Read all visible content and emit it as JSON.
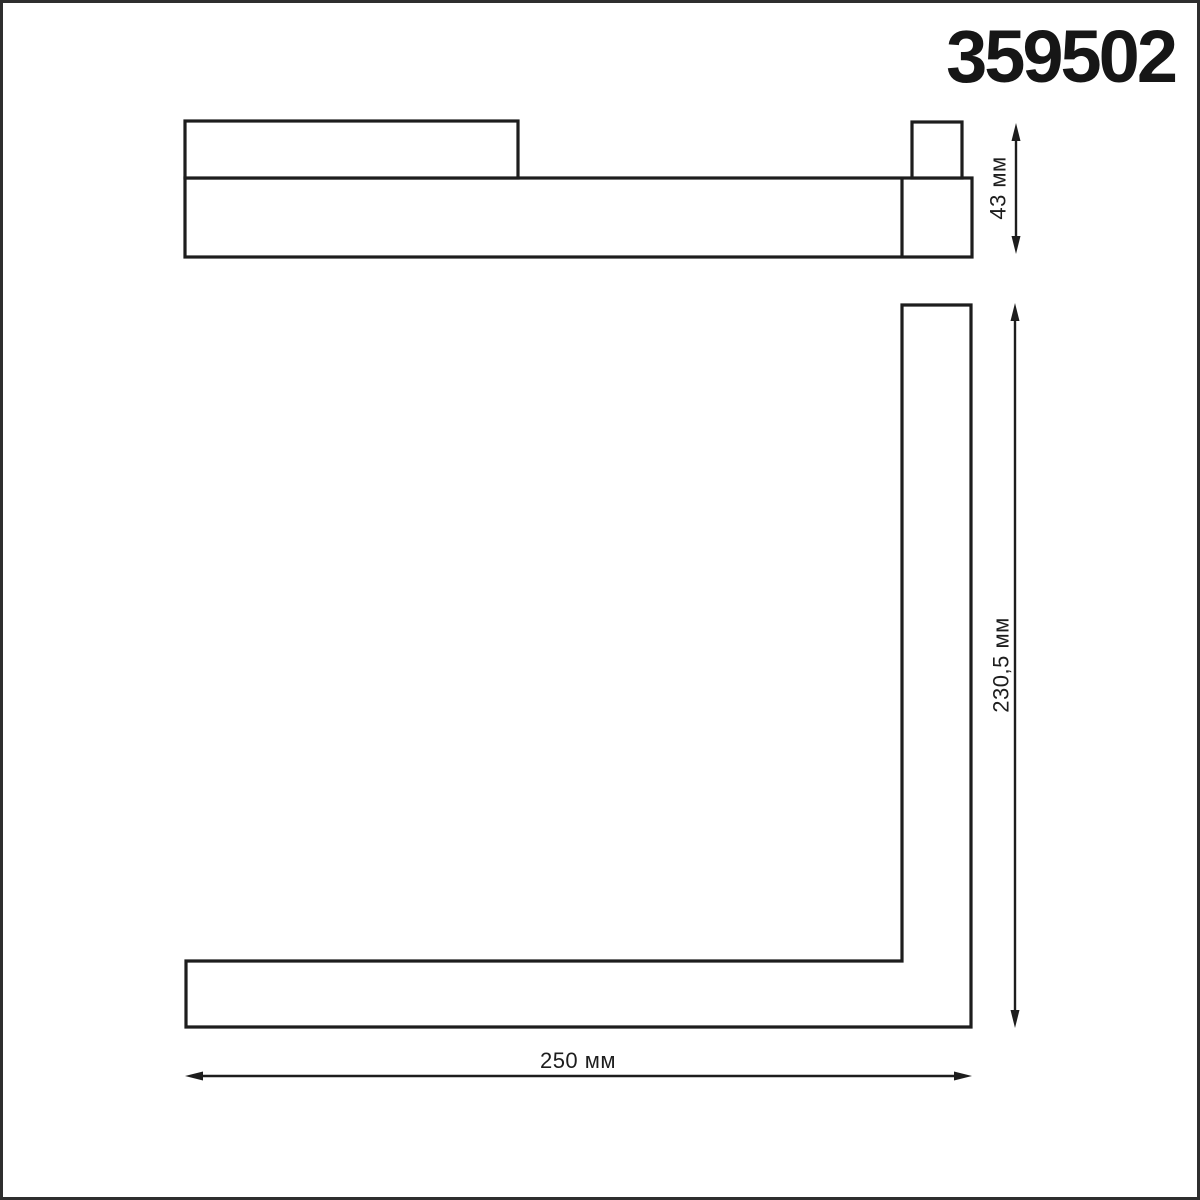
{
  "product_code": "359502",
  "views": {
    "side": {
      "name": "side-profile-view",
      "dimension_height": {
        "label": "43 мм",
        "value_mm": 43,
        "orientation": "vertical"
      }
    },
    "front": {
      "name": "front-l-shape-view",
      "dimension_height": {
        "label": "230,5 мм",
        "value_mm": 230.5,
        "orientation": "vertical"
      },
      "dimension_width": {
        "label": "250 мм",
        "value_mm": 250,
        "orientation": "horizontal"
      }
    }
  },
  "colors": {
    "line": "#1d1d1d",
    "background": "#ffffff",
    "frame_border": "#2e2e2e"
  }
}
